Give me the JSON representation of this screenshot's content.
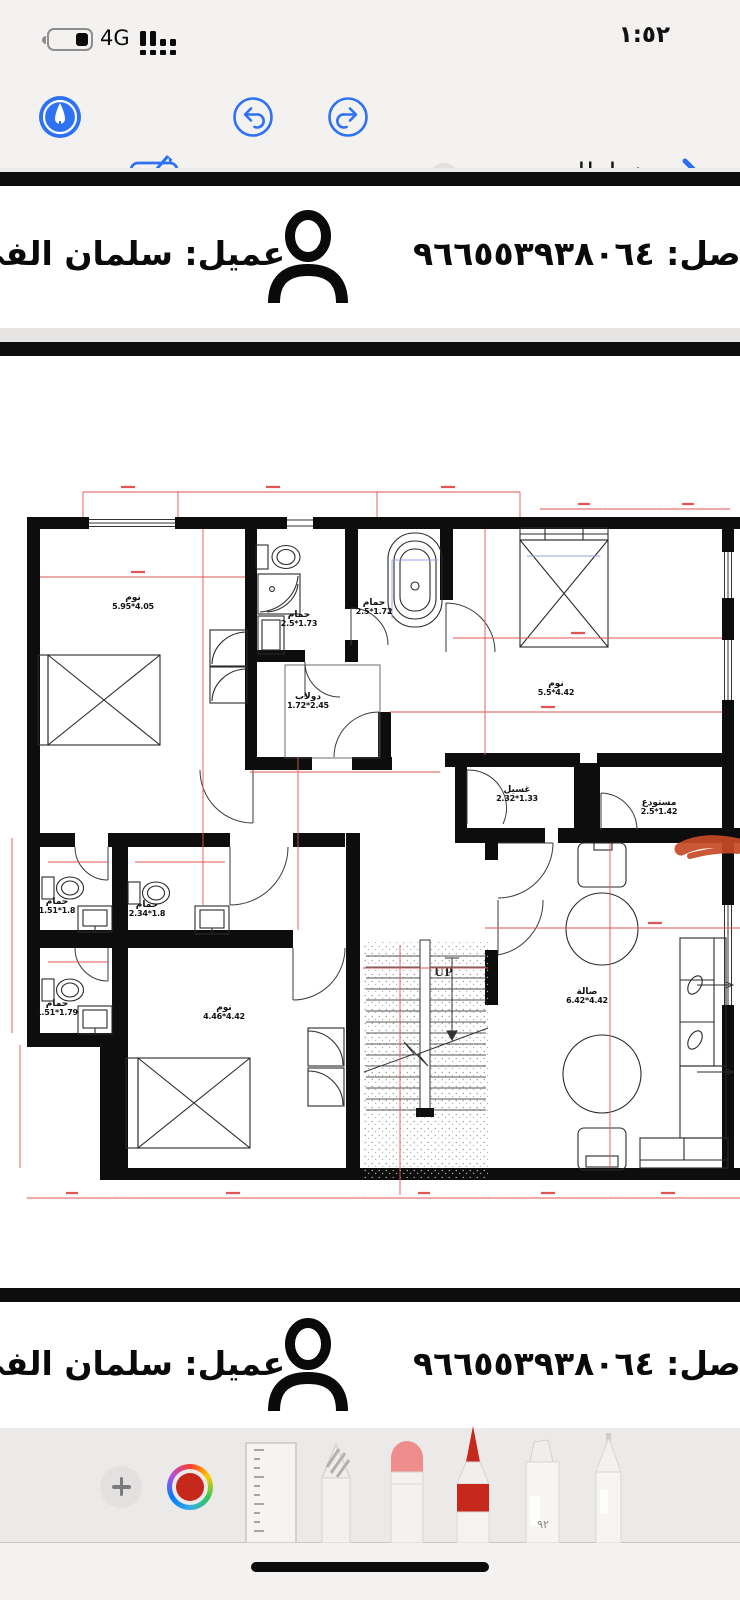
{
  "status_bar": {
    "time": "١:٥٢",
    "network_type": "4G"
  },
  "nav_toolbar": {
    "title": "مخططات م...",
    "accent_color": "#2e71f3"
  },
  "doc_header": {
    "contact": "اصل: ٩٦٦٥٥٣٩٣٨٠٦٤",
    "client": "عميل: سلمان الفي"
  },
  "floor_plan": {
    "stairs_label": "UP",
    "dim_color": "#e25555",
    "blue_dim_color": "#96a3dd",
    "annotation_color": "#c64a26",
    "rooms": [
      {
        "name": "نوم",
        "size": "5.95*4.05"
      },
      {
        "name": "حمام",
        "size": "2.5*1.73"
      },
      {
        "name": "حمام",
        "size": "2.5*1.72"
      },
      {
        "name": "دولاب",
        "size": "1.72*2.45"
      },
      {
        "name": "نوم",
        "size": "5.5*4.42"
      },
      {
        "name": "حمام",
        "size": "1.51*1.8"
      },
      {
        "name": "حمام",
        "size": "2.34*1.8"
      },
      {
        "name": "غسيل",
        "size": "2.32*1.33"
      },
      {
        "name": "مستودع",
        "size": "2.5*1.42"
      },
      {
        "name": "حمام",
        "size": "1.51*1.79"
      },
      {
        "name": "نوم",
        "size": "4.46*4.42"
      },
      {
        "name": "صالة",
        "size": "6.42*4.42"
      }
    ]
  },
  "markup_toolbar": {
    "selected_color": "#c6281c",
    "marker_label": "٩٢",
    "tools": [
      "add",
      "color-picker",
      "ruler",
      "pencil",
      "eraser",
      "colored-pencil",
      "marker",
      "pen"
    ]
  }
}
